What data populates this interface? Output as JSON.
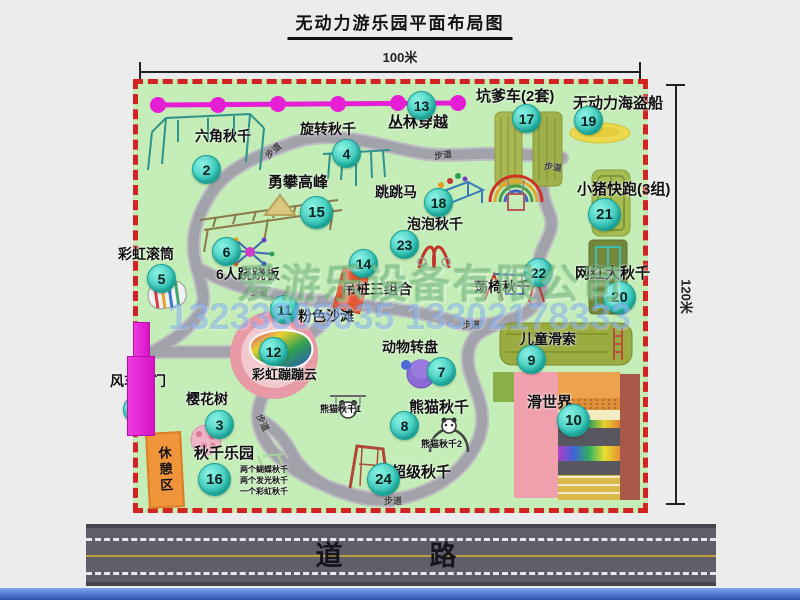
{
  "title": "无动力游乐园平面布局图",
  "dimension_labels": {
    "width": "100米",
    "height": "120米"
  },
  "road_label": "道　路",
  "watermark": {
    "company": "爱游乐设备有限公司",
    "phone": "13233805635 13302178333"
  },
  "rest_area_label": "休憩区",
  "trail_label_text": "步道",
  "colors": {
    "map_green": "#c4edb7",
    "border_red": "#d32222",
    "badge_teal": "#2ec4b6",
    "gate_magenta": "#d714c6",
    "rest_orange": "#f0953a",
    "road_gray": "#5f5e68",
    "chain_pink": "#e61ed6"
  },
  "attractions": [
    {
      "n": 1,
      "name": "风车大门",
      "bx": -2,
      "by": 324,
      "lx": -28,
      "ly": 287,
      "fs": 14
    },
    {
      "n": 2,
      "name": "六角秋千",
      "bx": 67,
      "by": 84,
      "lx": 57,
      "ly": 42,
      "fs": 14
    },
    {
      "n": 3,
      "name": "樱花树",
      "bx": 80,
      "by": 339,
      "lx": 48,
      "ly": 305,
      "fs": 14
    },
    {
      "n": 4,
      "name": "旋转秋千",
      "bx": 207,
      "by": 68,
      "lx": 162,
      "ly": 35,
      "fs": 14
    },
    {
      "n": 5,
      "name": "彩虹滚筒",
      "bx": 22,
      "by": 193,
      "lx": -20,
      "ly": 160,
      "fs": 14
    },
    {
      "n": 6,
      "name": "6人跷跷板",
      "bx": 87,
      "by": 166,
      "lx": 78,
      "ly": 180,
      "fs": 14
    },
    {
      "n": 7,
      "name": "动物转盘",
      "bx": 302,
      "by": 286,
      "lx": 244,
      "ly": 253,
      "fs": 14
    },
    {
      "n": 8,
      "name": "熊猫秋千",
      "bx": 265,
      "by": 340,
      "lx": 271,
      "ly": 312,
      "fs": 15
    },
    {
      "n": 9,
      "name": "儿童滑索",
      "bx": 392,
      "by": 274,
      "lx": 382,
      "ly": 245,
      "fs": 14
    },
    {
      "n": 10,
      "name": "滑世界",
      "bx": 434,
      "by": 335,
      "lx": 389,
      "ly": 307,
      "fs": 15,
      "big": true
    },
    {
      "n": 11,
      "name": "粉色沙滩",
      "bx": 145,
      "by": 224,
      "lx": 160,
      "ly": 222,
      "fs": 14
    },
    {
      "n": 12,
      "name": "彩虹蹦蹦云",
      "bx": 134,
      "by": 266,
      "lx": 114,
      "ly": 280,
      "fs": 13
    },
    {
      "n": 13,
      "name": "丛林穿越",
      "bx": 282,
      "by": 20,
      "lx": 250,
      "ly": 27,
      "fs": 15
    },
    {
      "n": 14,
      "name": "吊桩三组合",
      "bx": 224,
      "by": 178,
      "lx": 204,
      "ly": 195,
      "fs": 14
    },
    {
      "n": 15,
      "name": "勇攀高峰",
      "bx": 177,
      "by": 127,
      "lx": 130,
      "ly": 87,
      "fs": 15,
      "big": true
    },
    {
      "n": 16,
      "name": "秋千乐园",
      "bx": 75,
      "by": 394,
      "lx": 56,
      "ly": 358,
      "fs": 15,
      "big": true
    },
    {
      "n": 17,
      "name": "坑爹车(2套)",
      "bx": 387,
      "by": 33,
      "lx": 338,
      "ly": 1,
      "fs": 15
    },
    {
      "n": 18,
      "name": "跳跳马",
      "bx": 299,
      "by": 117,
      "lx": 237,
      "ly": 98,
      "fs": 14
    },
    {
      "n": 19,
      "name": "无动力海盗船",
      "bx": 449,
      "by": 35,
      "lx": 435,
      "ly": 8,
      "fs": 15
    },
    {
      "n": 20,
      "name": "网红大秋千",
      "bx": 480,
      "by": 212,
      "lx": 437,
      "ly": 178,
      "fs": 15,
      "big": true
    },
    {
      "n": 21,
      "name": "小猪快跑(3组)",
      "bx": 465,
      "by": 129,
      "lx": 439,
      "ly": 94,
      "fs": 15,
      "big": true
    },
    {
      "n": 22,
      "name": "荡椅秋千",
      "bx": 399,
      "by": 187,
      "lx": 336,
      "ly": 193,
      "fs": 14
    },
    {
      "n": 23,
      "name": "泡泡秋千",
      "bx": 265,
      "by": 159,
      "lx": 269,
      "ly": 130,
      "fs": 14
    },
    {
      "n": 24,
      "name": "超级秋千",
      "bx": 244,
      "by": 394,
      "lx": 253,
      "ly": 377,
      "fs": 15,
      "big": true
    }
  ],
  "extra_labels": [
    {
      "text": "熊猫秋千1",
      "x": 182,
      "y": 318,
      "fs": 9
    },
    {
      "text": "熊猫秋千2",
      "x": 283,
      "y": 353,
      "fs": 9
    },
    {
      "text": "两个蝴蝶秋千",
      "x": 102,
      "y": 380,
      "fs": 8
    },
    {
      "text": "两个发光秋千",
      "x": 102,
      "y": 391,
      "fs": 8
    },
    {
      "text": "一个彩虹秋千",
      "x": 102,
      "y": 402,
      "fs": 8
    }
  ],
  "trail_labels": [
    {
      "x": 126,
      "y": 60,
      "rot": -42
    },
    {
      "x": 296,
      "y": 64,
      "rot": -8
    },
    {
      "x": 406,
      "y": 76,
      "rot": 8
    },
    {
      "x": 112,
      "y": 202,
      "rot": 4
    },
    {
      "x": 324,
      "y": 234,
      "rot": 0
    },
    {
      "x": 116,
      "y": 332,
      "rot": 64
    },
    {
      "x": 246,
      "y": 410,
      "rot": 0
    }
  ],
  "icons": [
    "jungle-rope-chain",
    "hexagon-swing-frame",
    "rotary-swing-frame",
    "climbing-ladder-tent",
    "pit-cart-tracks",
    "pirate-ship-boat",
    "piggy-run-track",
    "big-net-swing-frame",
    "rainbow-arch-swing",
    "jump-horse-bed",
    "bubble-swing-arch",
    "rainbow-roller-drum",
    "seesaw-spinner",
    "hanging-post-block",
    "animal-carousel-disc",
    "chair-swing-frame",
    "windmill-gate",
    "cherry-blossom-tree",
    "panda-swing",
    "super-swing-frame",
    "kids-zipline-band",
    "slide-world-stripes",
    "rainbow-bounce-cloud"
  ]
}
